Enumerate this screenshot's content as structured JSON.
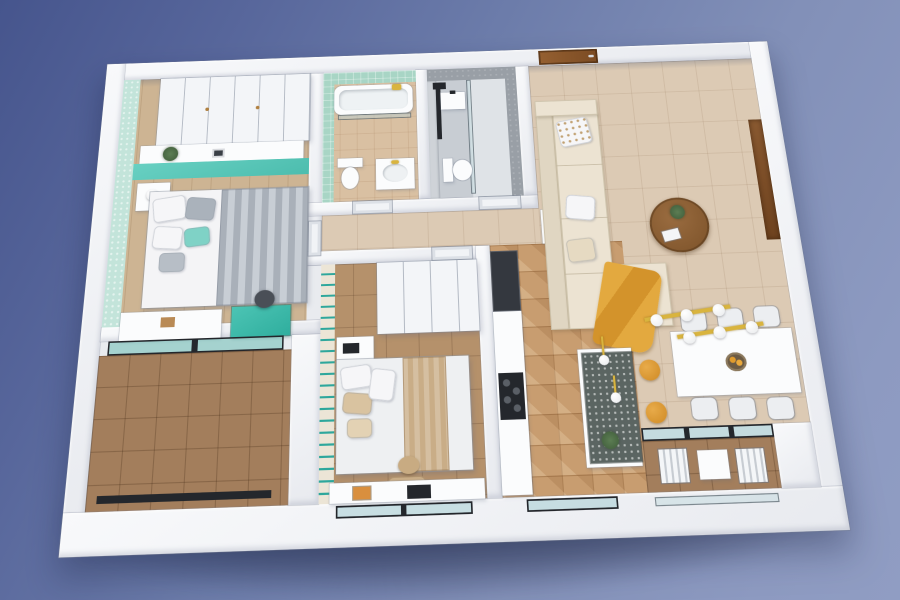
{
  "scene": {
    "title": "3D apartment floor plan render",
    "view": "isometric top-down cutaway",
    "background_sky_top": "#46558d",
    "background_sky_bottom": "#909dc3"
  },
  "palette": {
    "wall_white": "#f3f4f6",
    "mint_wallpaper": "#c3e4da",
    "teal_accent_wall": "#57c6b8",
    "bathroom_mint_tile": "#a8d5c5",
    "bathroom_grey_wall": "#999fa6",
    "entrance_door_wood": "#8a5a2e",
    "living_floor_tile": "#dccab4",
    "kitchen_parquet": "#c89d70",
    "balcony_tile": "#a37e5c",
    "sofa_cream": "#ece3d2",
    "throw_mustard": "#dd9b35",
    "stool_mustard": "#d98f2e",
    "pendant_gold": "#d9b43e",
    "glass": "#a8ced4",
    "window_frame_black": "#24272c",
    "island_terrazzo": "#5b6562"
  },
  "rooms": {
    "master_bedroom": {
      "name": "Master bedroom",
      "furniture": [
        "built-in wardrobe",
        "wall shelf with plant and photo frame",
        "double bed with grey striped duvet",
        "teal and grey pillows",
        "nightstand with lamp",
        "white dresser",
        "teal vanity desk",
        "desk chair"
      ]
    },
    "bathroom_mint": {
      "name": "Family bathroom",
      "furniture": [
        "bathtub with glass screen",
        "gold shower fixture",
        "washbasin with gold tap",
        "toilet"
      ]
    },
    "bathroom_grey": {
      "name": "Shower room",
      "furniture": [
        "walk-in shower with glass screen",
        "black shower column",
        "toilet",
        "washbasin",
        "white door"
      ]
    },
    "hallway": {
      "name": "Hallway",
      "furniture": [
        "white interior doors",
        "hall cabinet"
      ]
    },
    "entry": {
      "name": "Entry",
      "furniture": [
        "wooden entrance door"
      ]
    },
    "living_room": {
      "name": "Living room",
      "furniture": [
        "L-shaped cream sofa",
        "patterned cushion",
        "mustard throw blanket",
        "round wooden coffee table with plant",
        "wooden wall niche"
      ]
    },
    "dining_area": {
      "name": "Dining area",
      "furniture": [
        "white dining table",
        "six white chairs",
        "fruit bowl",
        "two gold pendant lights with globe bulbs"
      ]
    },
    "kitchen": {
      "name": "Kitchen",
      "furniture": [
        "tall dark appliance column",
        "white counter with black cooktop",
        "island with dark terrazzo top",
        "two mustard bar stools",
        "gold island pendants",
        "plant"
      ]
    },
    "bedroom_2": {
      "name": "Second bedroom",
      "furniture": [
        "striped accent wall",
        "white wardrobe",
        "nightstand with black radio",
        "double bed with tan blanket",
        "bench",
        "desk with laptop and book",
        "window"
      ]
    },
    "balcony_left": {
      "name": "Left balcony",
      "furniture": [
        "sliding glass door",
        "glass railing"
      ]
    },
    "balcony_right": {
      "name": "Right balcony",
      "furniture": [
        "sliding glass windows",
        "two white folding chairs",
        "small white table",
        "glass balustrade"
      ]
    }
  }
}
